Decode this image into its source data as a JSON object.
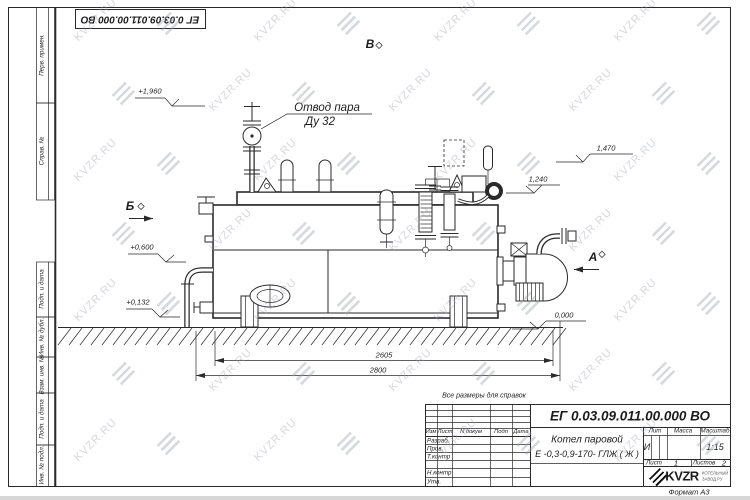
{
  "sheet": {
    "format_note": "Формат А3",
    "reference_note": "Все размеры для справок"
  },
  "watermark": {
    "text": "KVZR.RU"
  },
  "side_columns": {
    "labels": [
      "Перв. примен.",
      "Справ. №",
      "Подп. и дата",
      "Инв. № дубл.",
      "Взам. инв. №",
      "Подп. и дата",
      "Инв. № подл."
    ]
  },
  "drawing": {
    "callout": {
      "line1": "Отвод пара",
      "line2": "Ду 32"
    },
    "elevations": {
      "e1960": "+1,960",
      "e1470": "1,470",
      "e1240": "1,240",
      "e0600": "+0,600",
      "e0132": "+0,132",
      "e0000": "0,000"
    },
    "views": {
      "b": "Б",
      "v": "В",
      "a": "А"
    },
    "dimensions": {
      "d2605": "2605",
      "d2800": "2800"
    }
  },
  "titleblock": {
    "doc_number": "ЕГ 0.03.09.011.00.000  ВО",
    "product_name_line1": "Котел паровой",
    "product_name_line2": "Е -0,3-0,9-170- ГЛЖ ( Ж )",
    "header": {
      "izm": "Изм",
      "list": "Лист",
      "doc": "N докум",
      "podp": "Подп",
      "data": "Дата"
    },
    "rows": {
      "razrab": "Разраб.",
      "prov": "Пров.",
      "tkontr": "Т.контр",
      "nkontr": "Н.контр",
      "utv": "Утв."
    },
    "lit_label": "Лит",
    "lit_value": "И",
    "massa_label": "Масса",
    "masshtab_label": "Масштаб",
    "masshtab_value": "1:15",
    "list_label": "Лист",
    "list_value": "1",
    "listov_label": "Листов",
    "listov_value": "2",
    "logo": {
      "name": "KVZR",
      "sub1": "КОТЕЛЬНЫЙ",
      "sub2": "ЗАВОД.РУ"
    }
  }
}
